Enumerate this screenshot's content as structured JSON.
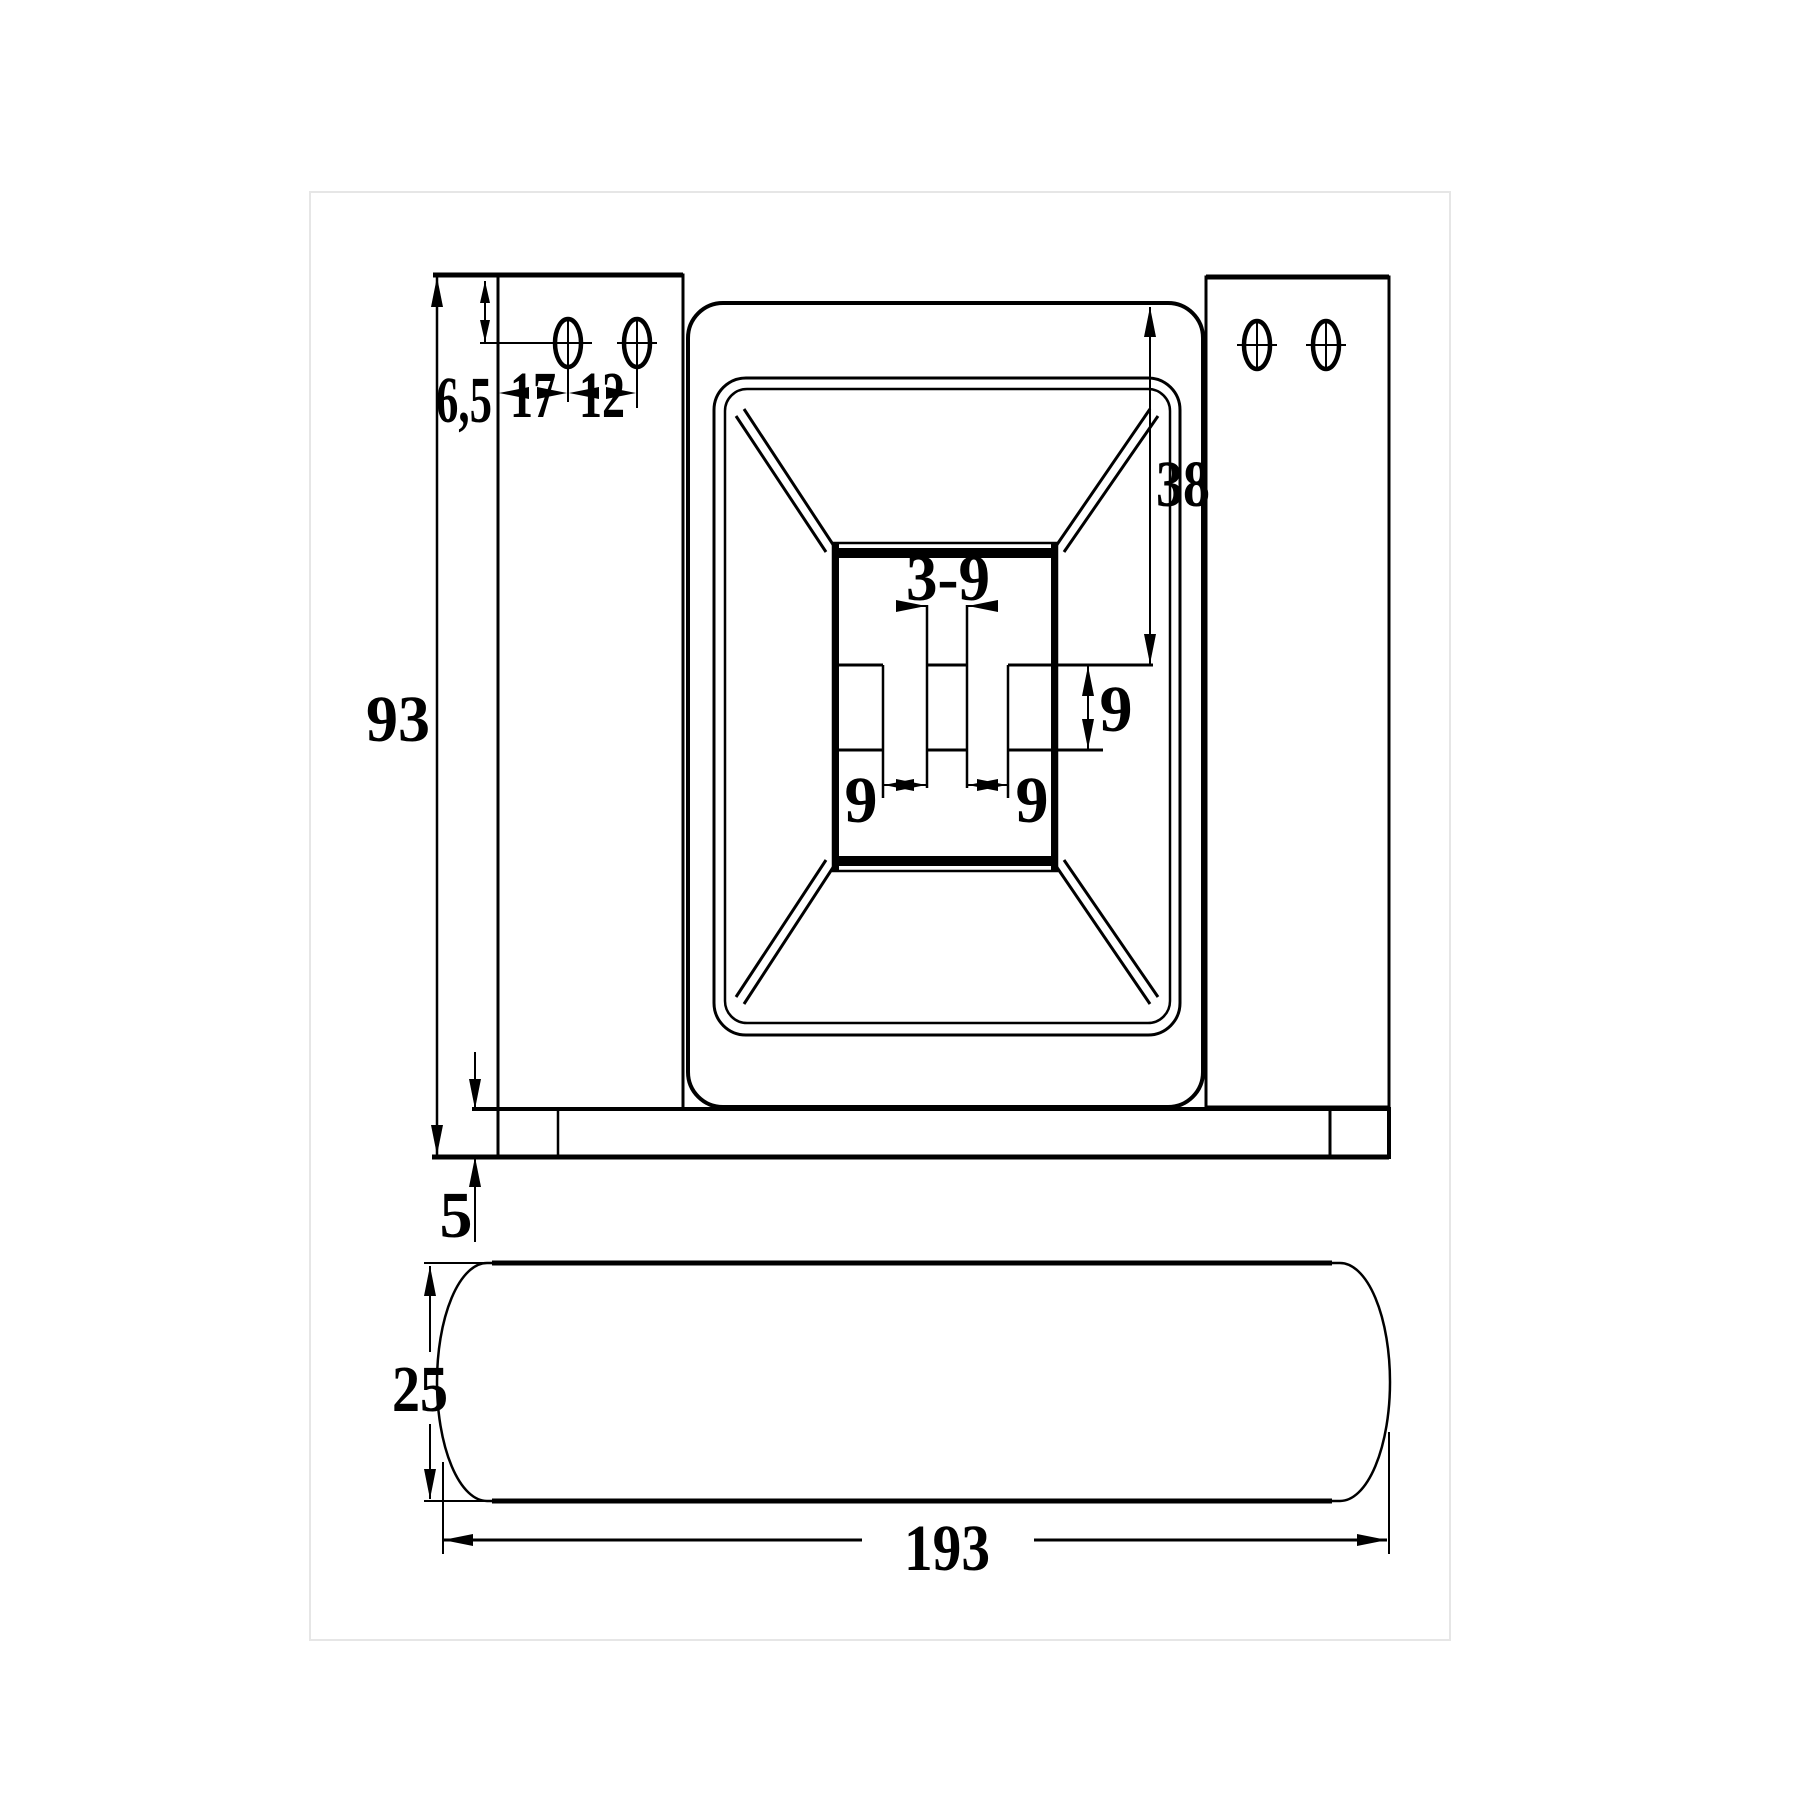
{
  "drawing": {
    "type": "technical-drawing",
    "colors": {
      "ink": "#000000",
      "paper": "#ffffff",
      "margin_line": "#e6e6e6"
    },
    "dimensions": {
      "front_view": {
        "overall_height": "93",
        "hole_center_from_top": "6,5",
        "hole_from_plate_edge": "17",
        "hole_pitch": "12",
        "recess_depth_to_slot": "38",
        "center_slot_width": "3-9",
        "slot_gap_left": "9",
        "slot_gap_right": "9",
        "slot_band_height": "9",
        "base_thickness": "5"
      },
      "side_view": {
        "profile_height": "25",
        "overall_length": "193"
      }
    }
  }
}
